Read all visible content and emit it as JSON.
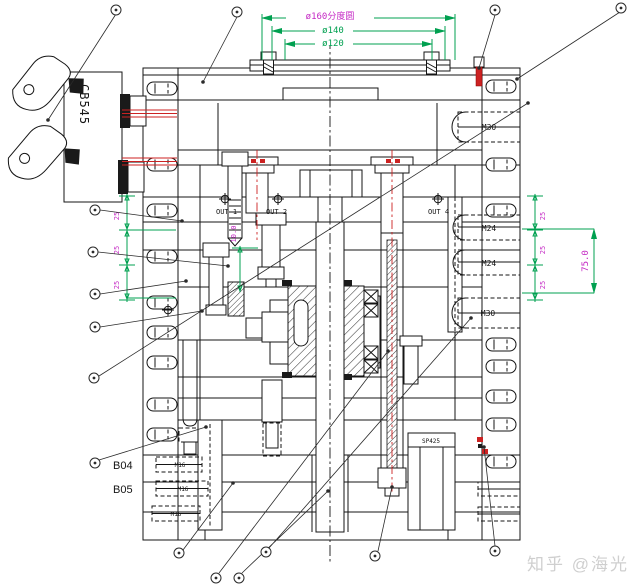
{
  "watermark": "知乎 @海光",
  "left_assembly": {
    "block_label": "CB545"
  },
  "ports": {
    "out1": "OUT 1",
    "out2": "OUT 2",
    "out4": "OUT 4"
  },
  "position_labels": {
    "b04": "B04",
    "b05": "B05",
    "spring": "SP425"
  },
  "threads": {
    "m30_top": "M30",
    "m24_upper": "M24",
    "m24_lower": "M24",
    "m30_mid": "M30",
    "m16_row1": "M16",
    "m16_row2": "M16",
    "m16_row3": "M16"
  },
  "dims": {
    "pitch_circle_dia": "ø160分度圆",
    "dia_140": "ø140",
    "dia_120": "ø120",
    "stack_total": "75.0",
    "stack_step": "25",
    "insert_depth": "10.0"
  },
  "colors": {
    "dimension_green": "#00A050",
    "annotation_magenta": "#C428C4",
    "highlight_red": "#CC2222",
    "drawing_black": "#151515",
    "watermark_gray": "#CFCFCF"
  }
}
